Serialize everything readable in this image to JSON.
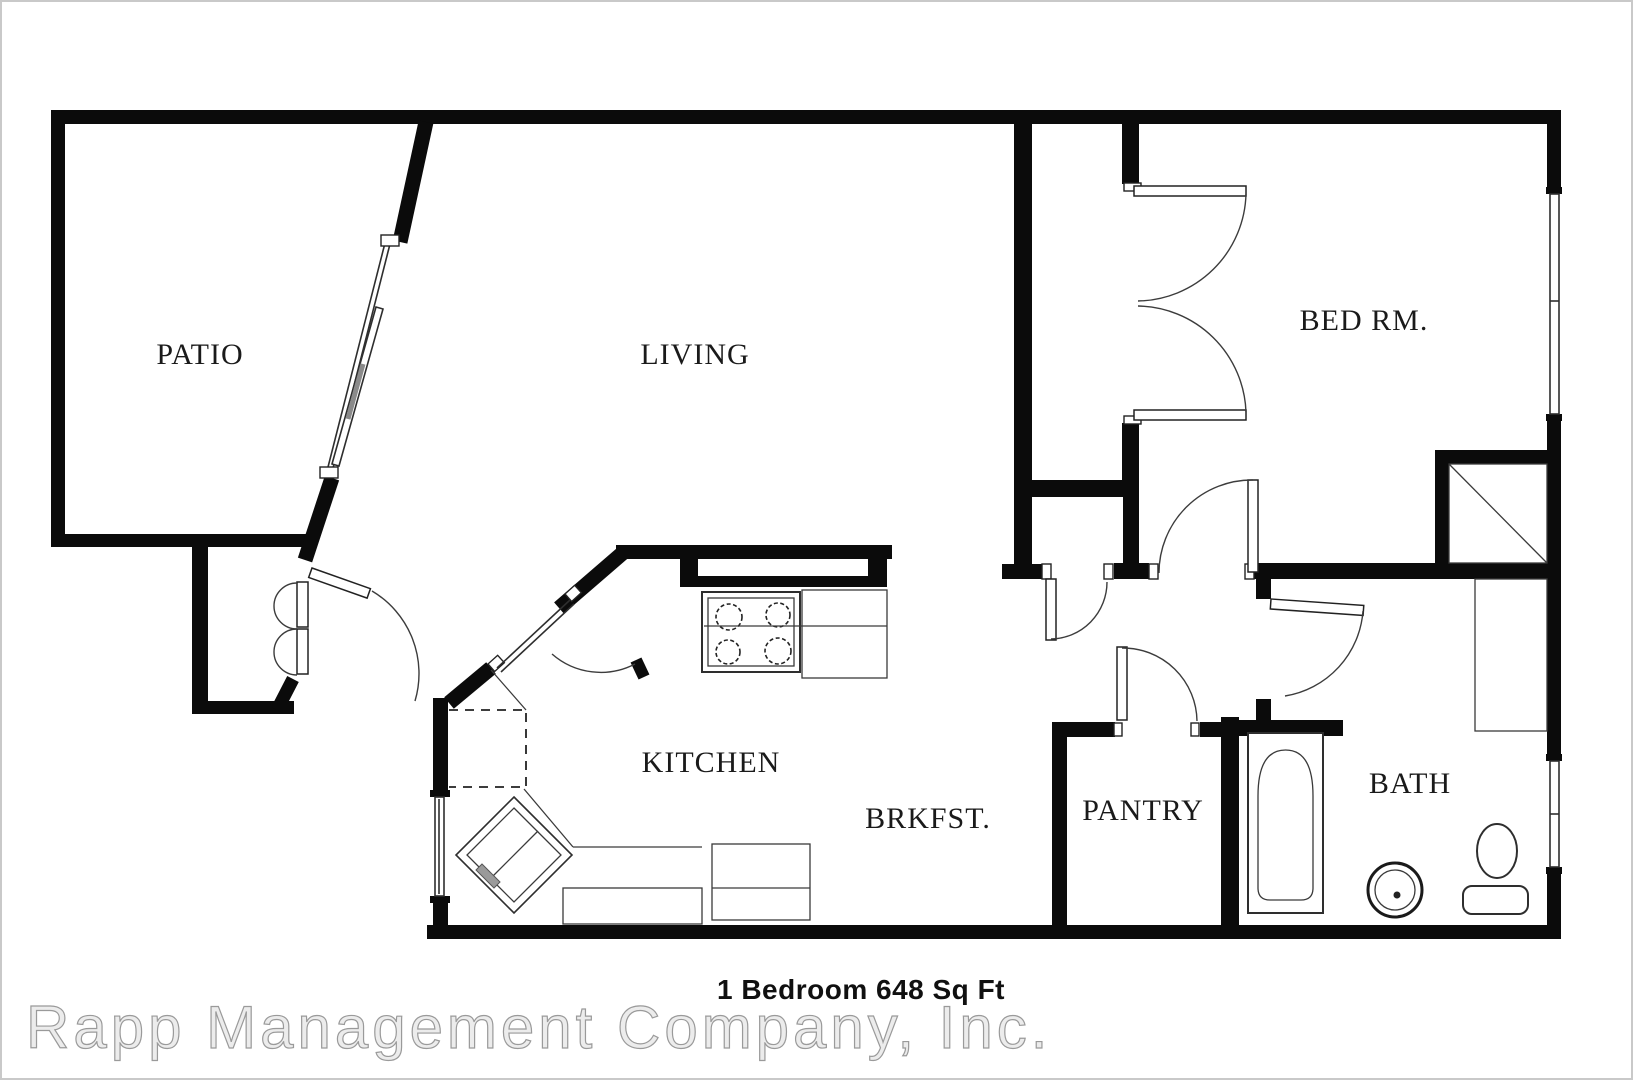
{
  "document": {
    "type": "apartment-floor-plan",
    "caption": "1 Bedroom 648 Sq Ft",
    "watermark": "Rapp Management Company, Inc."
  },
  "rooms": [
    {
      "id": "patio",
      "label": "PATIO"
    },
    {
      "id": "living",
      "label": "LIVING"
    },
    {
      "id": "bedroom",
      "label": "BED RM."
    },
    {
      "id": "kitchen",
      "label": "KITCHEN"
    },
    {
      "id": "breakfast",
      "label": "BRKFST."
    },
    {
      "id": "pantry",
      "label": "PANTRY"
    },
    {
      "id": "bath",
      "label": "BATH"
    }
  ],
  "fixtures": [
    "stove-cooktop-4-burners",
    "kitchen-corner-double-sink",
    "kitchen-counter",
    "dishwasher",
    "dashed-appliance-space",
    "bathtub",
    "bath-round-sink",
    "toilet-with-tank",
    "linen-closet",
    "bedroom-corner-closet",
    "bedroom-reach-in-closet",
    "patio-sliding-glass-door"
  ],
  "colors": {
    "walls": "#0b0b0b",
    "background": "#ffffff",
    "label_text": "#1a1a1a",
    "caption_text": "#101010",
    "watermark_fill": "#ececec",
    "watermark_outline": "#9a9a9a",
    "border": "#c9c9c9"
  }
}
